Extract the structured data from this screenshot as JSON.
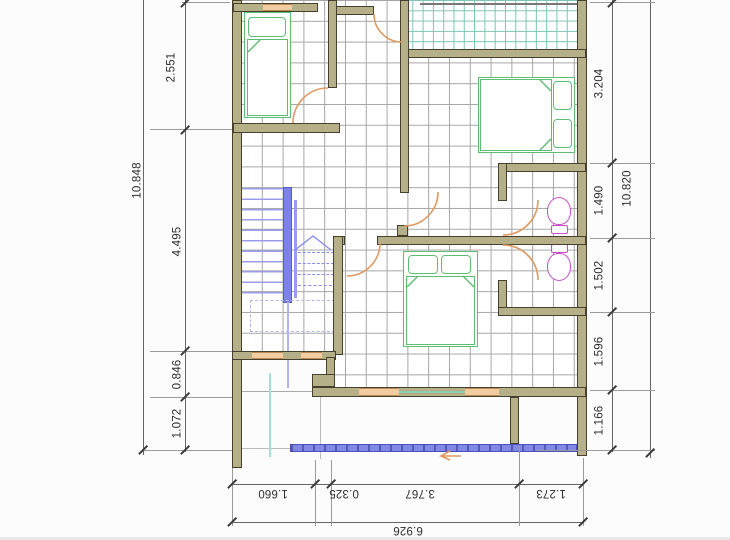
{
  "drawing": {
    "type": "architectural-floor-plan-second-floor",
    "colors": {
      "wall": "#b6b088",
      "wall_outline": "#45412e",
      "window": "#f2cda2",
      "grid": "#a6a6a6",
      "balcony_grid": "#7cc4b4",
      "bed": "#5dbd73",
      "toilet": "#c94fc9",
      "stair": "#7d81e8",
      "door": "#e09a62",
      "canopy": "#8388e4"
    },
    "dimensions": {
      "left": {
        "overall": "10.848",
        "segments": [
          "2.551",
          "4.495",
          "0.846",
          "1.072"
        ]
      },
      "right": {
        "overall": "10.820",
        "segments": [
          "3.204",
          "1.490",
          "1.502",
          "1.596",
          "1.166"
        ]
      },
      "bottom": {
        "overall": "6.926",
        "segments": [
          "1.660",
          "0.325",
          "3.767",
          "1.273"
        ]
      }
    }
  }
}
